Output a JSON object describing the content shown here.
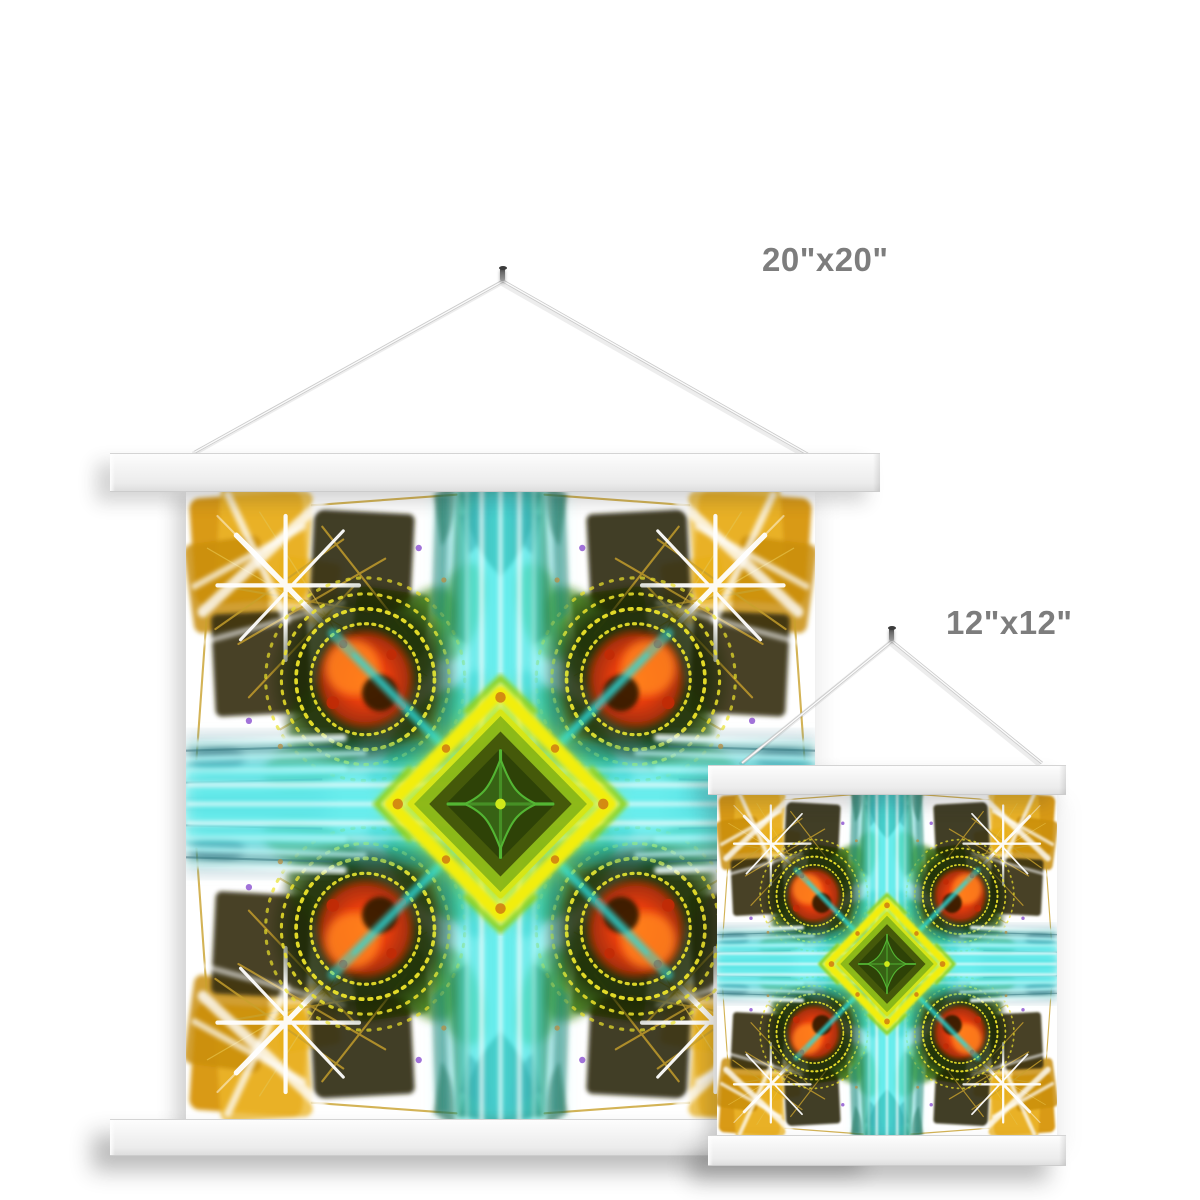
{
  "page": {
    "background_color": "#ffffff",
    "label_text_color": "#7d7d7d",
    "shadow_color": "#5a5a5a"
  },
  "products": {
    "large_print": {
      "size_label": "20\"x20\""
    },
    "small_print": {
      "size_label": "12\"x12\""
    }
  },
  "hanger": {
    "bar_color": "#f2f2f2",
    "string_color": "#cccccc",
    "nail_icon": "nail-pin"
  },
  "artwork": {
    "style": "abstract-kaleidoscope",
    "palette": {
      "cyan": "#2adede",
      "bright_yellow": "#f2ee10",
      "lime_green": "#88b40e",
      "dark_olive": "#2e4207",
      "red_orange": "#e63c0a",
      "amber": "#d99a12",
      "dark_patch": "#2f2a08",
      "white": "#ffffff",
      "slate_blue": "#7c8fa0"
    }
  }
}
